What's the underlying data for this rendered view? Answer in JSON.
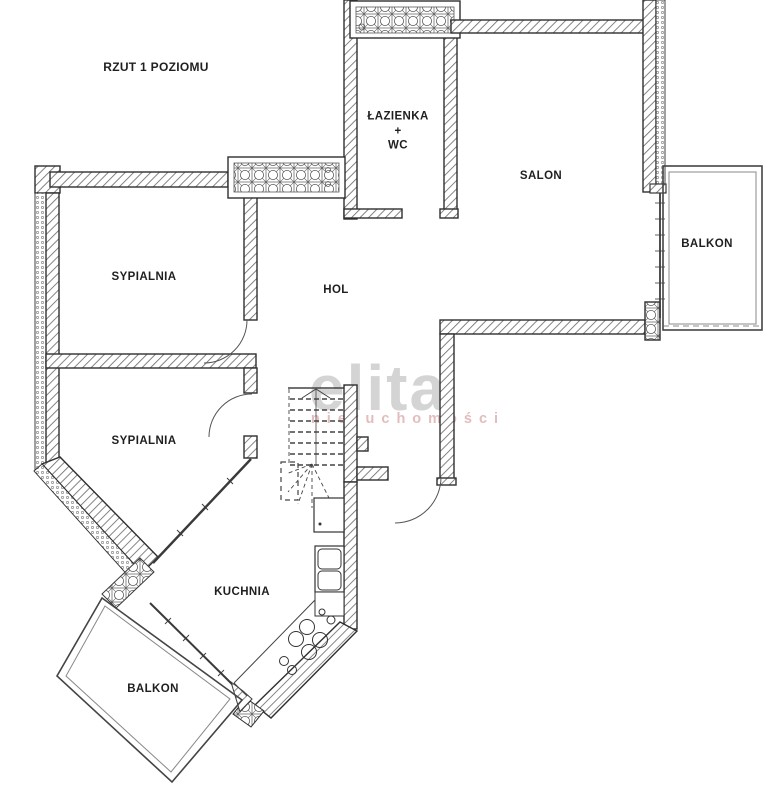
{
  "plan": {
    "title": "RZUT 1 POZIOMU",
    "rooms": {
      "bathroom": {
        "line1": "ŁAZIENKA",
        "line2": "+",
        "line3": "WC"
      },
      "salon": "SALON",
      "balkon_right": "BALKON",
      "bedroom1": "SYPIALNIA",
      "hall": "HOL",
      "bedroom2": "SYPIALNIA",
      "kitchen": "KUCHNIA",
      "balkon_bottom": "BALKON"
    },
    "watermark": {
      "primary": "elita",
      "secondary": "nieruchomości"
    },
    "colors": {
      "wall_outline": "#2f2f2f",
      "wall_hatch": "#6e6e6e",
      "label_text": "#1f1f1f",
      "watermark_gray": "#d4d4d4",
      "watermark_pink": "#e3bdbd"
    }
  }
}
